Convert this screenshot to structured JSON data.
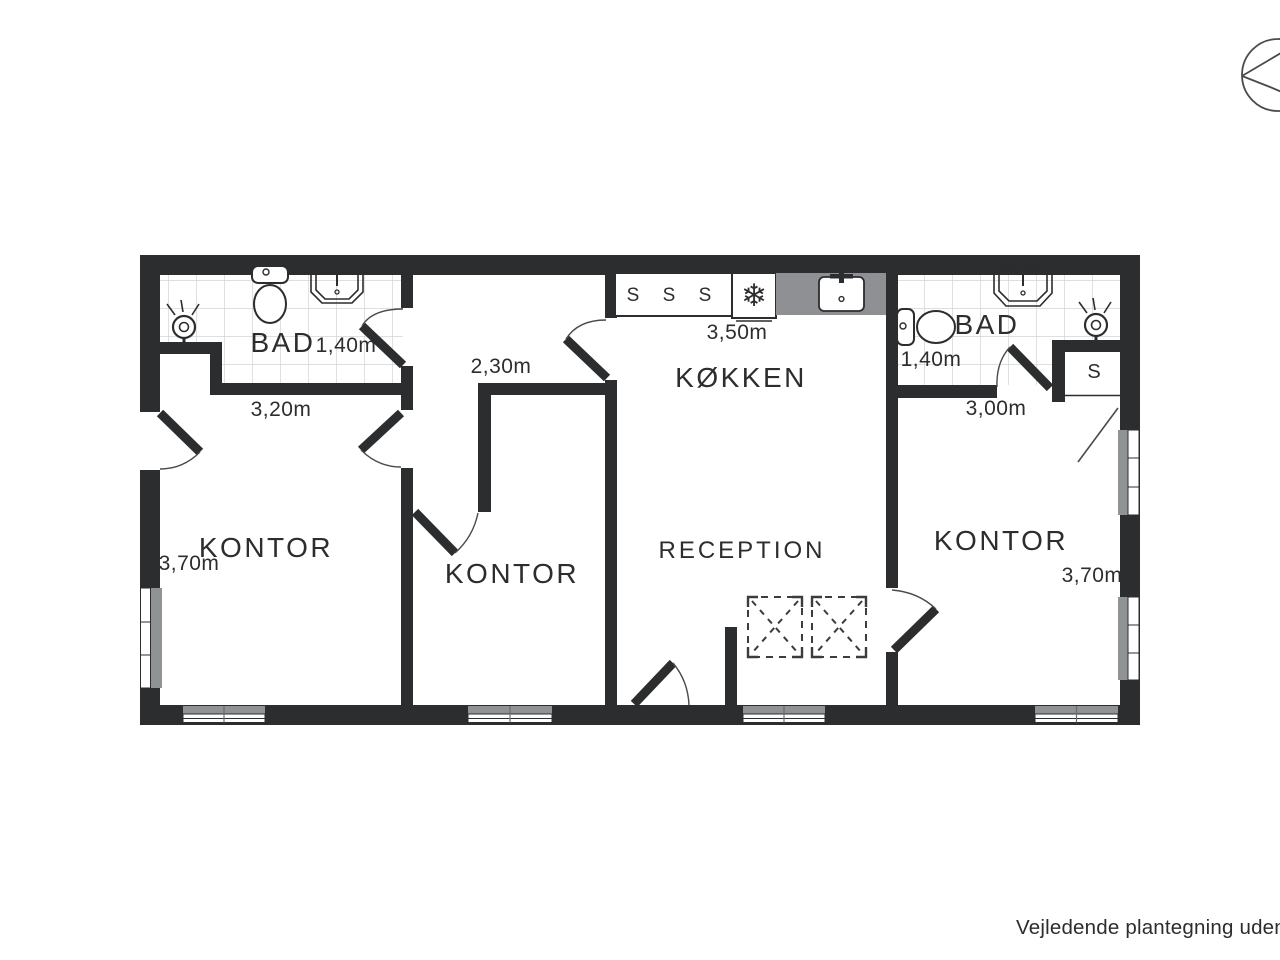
{
  "plan": {
    "rooms": {
      "bad_left": {
        "name": "BAD",
        "dim_depth": "1,40m",
        "dim_width": "3,20m"
      },
      "kontor_left": {
        "name": "KONTOR",
        "dim_width": "3,70m"
      },
      "kontor_middle": {
        "name": "KONTOR",
        "dim_width": "2,30m"
      },
      "kokken": {
        "name": "KØKKEN",
        "dim_width": "3,50m"
      },
      "reception": {
        "name": "RECEPTION"
      },
      "kontor_right": {
        "name": "KONTOR",
        "dim_width": "3,70m"
      },
      "bad_right": {
        "name": "BAD",
        "dim_depth": "1,40m",
        "dim_width": "3,00m"
      }
    },
    "fixtures": {
      "cabinet_letter": "S",
      "closet_letter": "S"
    },
    "icons": {
      "freezer_glyph": "❄"
    },
    "colors": {
      "wall": "#2b2d2e",
      "window_gray": "#909394",
      "counter_gray": "#8e9093",
      "tile_line": "#cccccc"
    },
    "footer": {
      "disclaimer": "Vejledende plantegning uden a"
    }
  }
}
